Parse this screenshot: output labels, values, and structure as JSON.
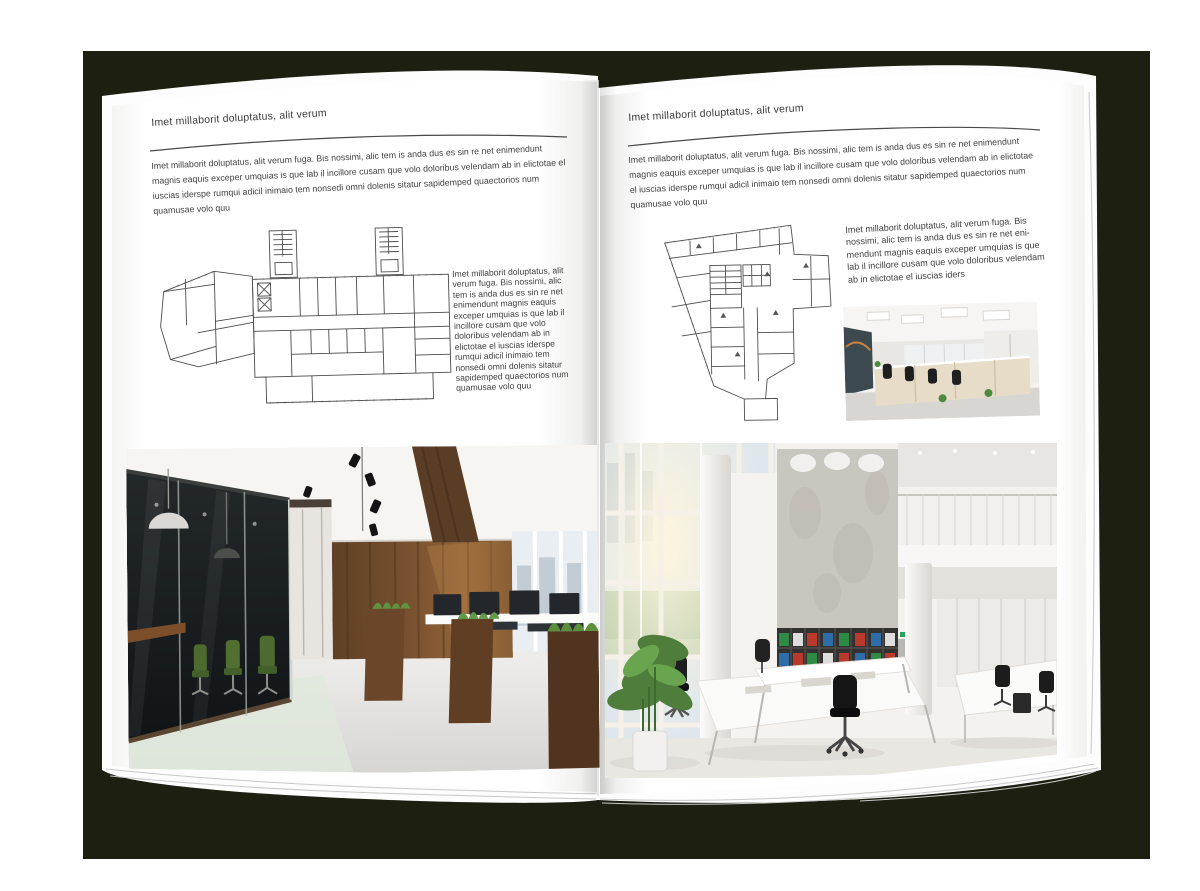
{
  "palette": {
    "backdrop": "#1d1f11",
    "page": "#ffffff",
    "body_text": "#3f3f3f",
    "rule": "#4a4a4a"
  },
  "book": {
    "left_page": {
      "header": "Imet millaborit doluptatus, alit verum",
      "intro": "Imet millaborit doluptatus, alit verum fuga. Bis nossimi, alic tem is anda dus es sin re net enimendunt magnis eaquis exceper umquias is que lab il incillore cusam que volo doloribus velendam ab in elictotae el iuscias iderspe rumqui adicil inimaio tem nonsedi omni dolenis sitatur sapidemped quaectorios num quamusae volo quu",
      "side_text": "Imet millaborit doluptatus, alit verum fuga. Bis nossimi, alic tem is anda dus es sin re net enimendunt magnis eaquis exceper umquias is que lab il incillore cusam que volo doloribus velendam ab in elictotae el iuscias iderspe rumqui adicil inimaio tem nonsedi omni dolenis sitatur sapidemped quaectorios num quamusae volo quu",
      "floor_plan_alt": "architectural floor plan of a wide building with two stair towers",
      "photo_alt": "office interior with dark glass meeting room, green chairs, wooden wall and workstations"
    },
    "right_page": {
      "header": "Imet millaborit doluptatus, alit verum",
      "intro": "Imet millaborit doluptatus, alit verum fuga. Bis nossimi, alic tem is anda dus es sin re net enimendunt magnis eaquis exceper umquias is que lab il incillore cusam que volo doloribus velendam ab in elictotae el iuscias iderspe rumqui adicil inimaio tem nonsedi omni dolenis sitatur sapidemped quaectorios num quamusae volo quu",
      "side_text": "Imet millaborit doluptatus, alit verum fuga. Bis nossimi, alic tem is anda dus es sin re net eni-mendunt magnis eaquis exceper umquias is que lab il incillore cusam que volo doloribus velendam ab in elictotae el iuscias iders",
      "floor_plan_alt": "architectural floor plan of a tall wedge-shaped building",
      "photo_small_alt": "bright open-plan office with rows of desks and black chairs",
      "photo_large_alt": "double-height white office atrium with concrete wall, shelves of binders and white desks"
    }
  }
}
